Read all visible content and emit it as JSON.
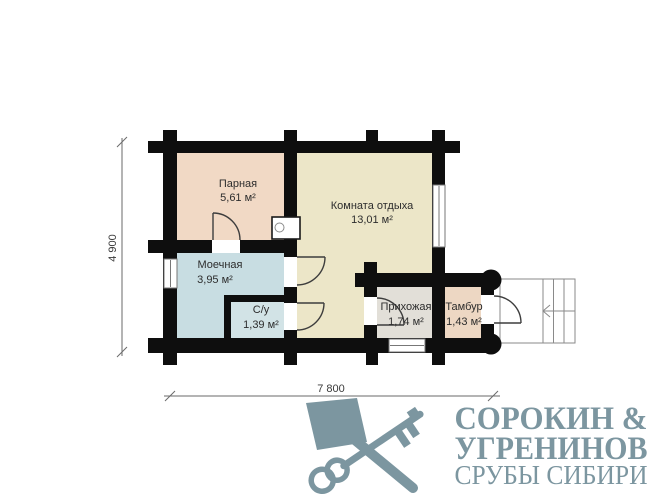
{
  "plan": {
    "rooms": [
      {
        "name": "Парная",
        "area": "5,61 м²",
        "color": "#f1d9c5"
      },
      {
        "name": "Комната отдыха",
        "area": "13,01 м²",
        "color": "#ece6c8"
      },
      {
        "name": "Моечная",
        "area": "3,95 м²",
        "color": "#c8dde2"
      },
      {
        "name": "С/у",
        "area": "1,39 м²",
        "color": "#d2e3e6"
      },
      {
        "name": "Прихожая",
        "area": "1,74 м²",
        "color": "#e2dfd8"
      },
      {
        "name": "Тамбур",
        "area": "1,43 м²",
        "color": "#edd7c3"
      }
    ],
    "wall_color": "#0e0e0e",
    "dimensions": {
      "width": "7 800",
      "height": "4 900"
    }
  },
  "logo": {
    "line1": "СОРОКИН &",
    "line2": "УГРЕНИНОВ",
    "line3": "СРУБЫ СИБИРИ",
    "color": "#7c96a0"
  }
}
